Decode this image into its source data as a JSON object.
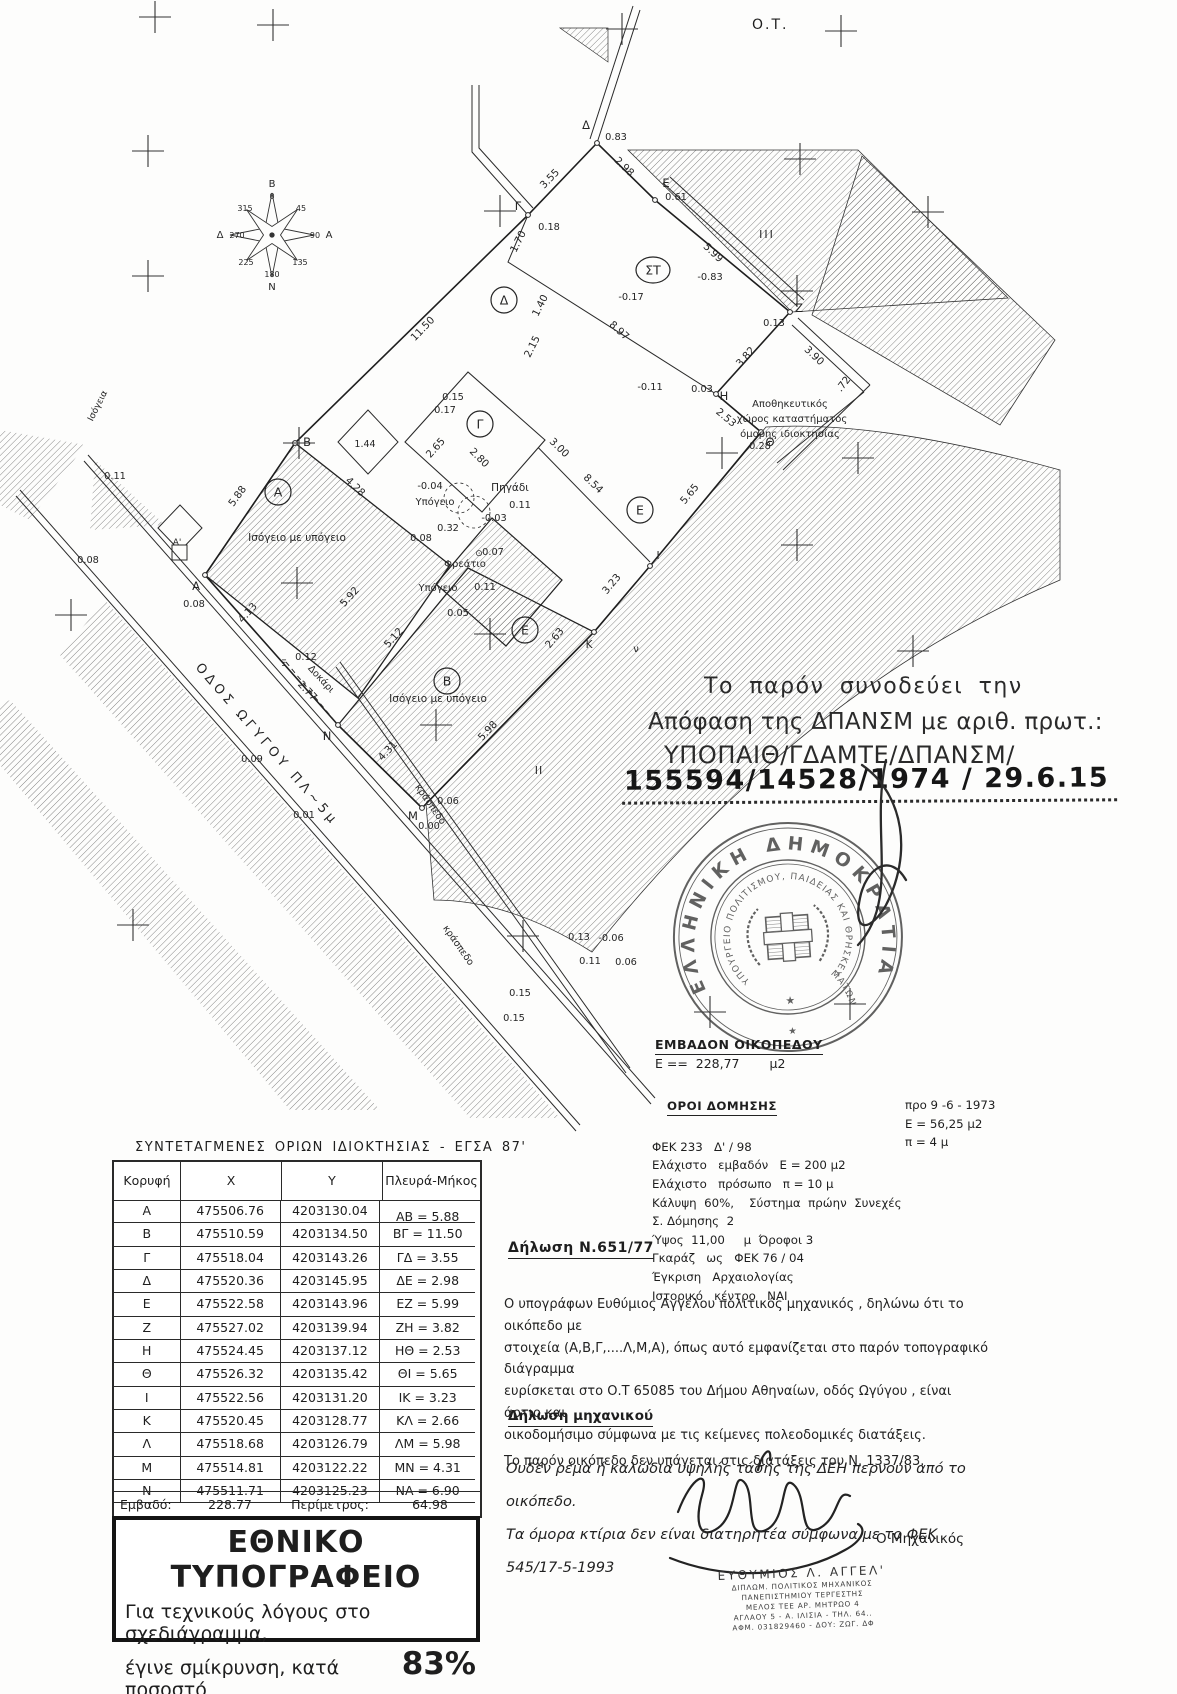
{
  "page": {
    "ot_label": "Ο.Τ."
  },
  "approval": {
    "line1": "Το παρόν συνοδεύει την",
    "line2": "Απόφαση της ΔΠΑΝΣΜ με αριθ. πρωτ.:",
    "line3": "ΥΠΟΠΑΙΘ/ΓΔΑΜΤΕ/ΔΠΑΝΣΜ/",
    "line4": "155594/14528/1974 / 29.6.15"
  },
  "stamp": {
    "outer_text": "ΕΛΛΗΝΙΚΗ ΔΗΜΟΚΡΑΤΙΑ",
    "inner_text": "ΥΠΟΥΡΓΕΙΟ ΠΟΛΙΤΙΣΜΟΥ, ΠΑΙΔΕΙΑΣ ΚΑΙ ΘΡΗΣΚΕΥΜΑΤΩΝ",
    "star1": "★",
    "star2": "★"
  },
  "area_block": {
    "title": "ΕΜΒΑΔΟΝ ΟΙΚΟΠΕΔΟΥ",
    "value": "Ε ==  228,77",
    "unit": "μ2"
  },
  "building_terms": {
    "title": "ΟΡΟΙ ΔΟΜΗΣΗΣ",
    "left_rows": [
      "ΦΕΚ 233   Δ' / 98",
      "Ελάχιστο   εμβαδόν   Ε = 200 μ2",
      "Ελάχιστο   πρόσωπο   π = 10 μ",
      "Κάλυψη  60%,    Σύστημα  πρώην  Συνεχές",
      "Σ. Δόμησης  2",
      "Ύψος  11,00     μ  Όροφοι 3",
      "Γκαράζ   ως   ΦΕΚ 76 / 04",
      "Έγκριση   Αρχαιολογίας",
      "Ιστορικό   κέντρο   ΝΑΙ"
    ],
    "right_rows": [
      "προ 9 -6 - 1973",
      "Ε = 56,25 μ2",
      "π = 4 μ"
    ]
  },
  "coords_table": {
    "title": "ΣΥΝΤΕΤΑΓΜΕΝΕΣ ΟΡΙΩΝ ΙΔΙΟΚΤΗΣΙΑΣ - ΕΓΣΑ 87'",
    "headers": [
      "Κορυφή",
      "X",
      "Y",
      "Πλευρά-Μήκος"
    ],
    "rows": [
      [
        "Α",
        "475506.76",
        "4203130.04"
      ],
      [
        "Β",
        "475510.59",
        "4203134.50"
      ],
      [
        "Γ",
        "475518.04",
        "4203143.26"
      ],
      [
        "Δ",
        "475520.36",
        "4203145.95"
      ],
      [
        "Ε",
        "475522.58",
        "4203143.96"
      ],
      [
        "Ζ",
        "475527.02",
        "4203139.94"
      ],
      [
        "Η",
        "475524.45",
        "4203137.12"
      ],
      [
        "Θ",
        "475526.32",
        "4203135.42"
      ],
      [
        "Ι",
        "475522.56",
        "4203131.20"
      ],
      [
        "Κ",
        "475520.45",
        "4203128.77"
      ],
      [
        "Λ",
        "475518.68",
        "4203126.79"
      ],
      [
        "Μ",
        "475514.81",
        "4203122.22"
      ],
      [
        "Ν",
        "475511.71",
        "4203125.23"
      ]
    ],
    "sides": [
      "ΑΒ = 5.88",
      "ΒΓ = 11.50",
      "ΓΔ = 3.55",
      "ΔΕ = 2.98",
      "ΕΖ = 5.99",
      "ΖΗ = 3.82",
      "ΗΘ = 2.53",
      "ΘΙ = 5.65",
      "ΙΚ = 3.23",
      "ΚΛ = 2.66",
      "ΛΜ = 5.98",
      "ΜΝ = 4.31",
      "ΝΑ = 6.90"
    ],
    "footer": {
      "area_label": "Εμβαδό:",
      "area": "228.77",
      "perimeter_label": "Περίμετρος:",
      "perimeter": "64.98"
    }
  },
  "print_box": {
    "title": "ΕΘΝΙΚΟ ΤΥΠΟΓΡΑΦΕΙΟ",
    "line1": "Για τεχνικούς λόγους στο σχεδιάγραμμα,",
    "line2_prefix": "έγινε σμίκρυνση, κατά ποσοστό",
    "percent": "83%"
  },
  "declaration_651": {
    "title": "Δήλωση  Ν.651/77",
    "lines": [
      "Ο υπογράφων Ευθύμιος Αγγέλου πολιτικός μηχανικός , δηλώνω ότι  το οικόπεδο με",
      "στοιχεία (Α,Β,Γ,....Λ,Μ,Α), όπως αυτό εμφανίζεται στο παρόν τοπογραφικό διάγραμμα",
      "ευρίσκεται στο Ο.Τ 65085 του Δήμου Αθηναίων, οδός Ωγύγου , είναι άρτιο και",
      "οικοδομήσιμο σύμφωνα με τις κείμενες  πολεοδομικές διατάξεις.",
      "Το παρόν οικόπεδο δεν υπάγεται στις διατάξεις του Ν. 1337/83."
    ]
  },
  "declaration_engineer": {
    "title": "Δήλωση μηχανικού",
    "lines": [
      "Ουδέν ρέμα ή καλώδια υψηλής τάσης της ΔΕΗ περνούν από το οικόπεδο.",
      "Τα όμορα κτίρια δεν είναι διατηρητέα  σύμφωνα με το ΦΕΚ 545/17-5-1993"
    ]
  },
  "signature": {
    "role": "Ο Μηχανικός",
    "stamp_lines": [
      "ΕΥΘΥΜΙΟΣ Λ. ΑΓΓΕΛ'",
      "ΔΙΠΛΩΜ. ΠΟΛΙΤΙΚΟΣ ΜΗΧΑΝΙΚΟΣ",
      "ΠΑΝΕΠΙΣΤΗΜΙΟΥ ΤΕΡΓΕΣΤΗΣ",
      "ΜΕΛΟΣ ΤΕΕ    ΑΡ. ΜΗΤΡΩΟ 4",
      "ΑΓΛΑΟΥ 5 - Α. ΙΛΙΣΙΑ  -  ΤΗΛ. 64..",
      "ΑΦΜ. 031829460  -  ΔΟΥ: ΖΩΓ. ΔΦ"
    ]
  },
  "map": {
    "street_name": "ΟΔΟΣ  ΩΓΥΓΟΥ  ΠΛ~5μ",
    "texts": [
      {
        "t": "Β",
        "x": 272,
        "y": 187,
        "s": 10
      },
      {
        "t": "0",
        "x": 272,
        "y": 199,
        "s": 8
      },
      {
        "t": "45",
        "x": 301,
        "y": 211,
        "s": 8
      },
      {
        "t": "90",
        "x": 315,
        "y": 238,
        "s": 8
      },
      {
        "t": "Α",
        "x": 329,
        "y": 238,
        "s": 10
      },
      {
        "t": "135",
        "x": 300,
        "y": 265,
        "s": 8
      },
      {
        "t": "180",
        "x": 272,
        "y": 277,
        "s": 8
      },
      {
        "t": "Ν",
        "x": 272,
        "y": 290,
        "s": 10
      },
      {
        "t": "225",
        "x": 246,
        "y": 265,
        "s": 8
      },
      {
        "t": "270",
        "x": 237,
        "y": 238,
        "s": 8
      },
      {
        "t": "Δ",
        "x": 220,
        "y": 238,
        "s": 10
      },
      {
        "t": "315",
        "x": 245,
        "y": 211,
        "s": 8
      },
      {
        "t": "Α",
        "x": 196,
        "y": 590,
        "s": 11.5
      },
      {
        "t": "Β",
        "x": 307,
        "y": 446,
        "s": 11.5
      },
      {
        "t": "Γ",
        "x": 518,
        "y": 210,
        "s": 11.5
      },
      {
        "t": "Δ",
        "x": 586,
        "y": 129,
        "s": 11.5
      },
      {
        "t": "Ε",
        "x": 666,
        "y": 187,
        "s": 11.5
      },
      {
        "t": "Ζ",
        "x": 799,
        "y": 312,
        "s": 11.5
      },
      {
        "t": "Η",
        "x": 724,
        "y": 400,
        "s": 11.5
      },
      {
        "t": "Θ",
        "x": 770,
        "y": 446,
        "s": 11.5
      },
      {
        "t": "Ι",
        "x": 658,
        "y": 559,
        "s": 10.5
      },
      {
        "t": "Κ",
        "x": 589,
        "y": 648,
        "s": 10.5
      },
      {
        "t": "Μ",
        "x": 413,
        "y": 820,
        "s": 11.5
      },
      {
        "t": "Ν",
        "x": 327,
        "y": 740,
        "s": 11.5
      },
      {
        "t": "Ξ",
        "x": 284,
        "y": 666,
        "s": 9
      },
      {
        "t": "ν",
        "x": 636,
        "y": 652,
        "s": 10
      },
      {
        "t": "Α'",
        "x": 177,
        "y": 545,
        "s": 9
      },
      {
        "t": "5.88",
        "x": 240,
        "y": 498,
        "r": -54
      },
      {
        "t": "4.28",
        "x": 353,
        "y": 489,
        "r": 44
      },
      {
        "t": "11.50",
        "x": 425,
        "y": 331,
        "r": -46
      },
      {
        "t": "3.55",
        "x": 552,
        "y": 181,
        "r": -46
      },
      {
        "t": "2.98",
        "x": 622,
        "y": 169,
        "r": 44
      },
      {
        "t": "5.99",
        "x": 711,
        "y": 255,
        "r": 43
      },
      {
        "t": "3.82",
        "x": 748,
        "y": 359,
        "r": -48
      },
      {
        "t": "2.53",
        "x": 724,
        "y": 420,
        "r": 40
      },
      {
        "t": "5.65",
        "x": 692,
        "y": 496,
        "r": -50
      },
      {
        "t": "3.23",
        "x": 614,
        "y": 586,
        "r": -50
      },
      {
        "t": "2.63",
        "x": 557,
        "y": 640,
        "r": -50
      },
      {
        "t": "5.98",
        "x": 490,
        "y": 733,
        "r": -47
      },
      {
        "t": "4.31",
        "x": 390,
        "y": 753,
        "r": -47
      },
      {
        "t": "5.12",
        "x": 396,
        "y": 640,
        "r": -48
      },
      {
        "t": "4.13",
        "x": 250,
        "y": 615,
        "r": -48
      },
      {
        "t": "5.92",
        "x": 352,
        "y": 599,
        "r": -48
      },
      {
        "t": "8.97",
        "x": 617,
        "y": 333,
        "r": 42
      },
      {
        "t": "8.54",
        "x": 591,
        "y": 486,
        "r": 44
      },
      {
        "t": "3.00",
        "x": 557,
        "y": 450,
        "r": 44
      },
      {
        "t": "2.80",
        "x": 477,
        "y": 460,
        "r": 45
      },
      {
        "t": "2.65",
        "x": 438,
        "y": 450,
        "r": -48
      },
      {
        "t": "1.70",
        "x": 521,
        "y": 243,
        "r": -63
      },
      {
        "t": "1.40",
        "x": 543,
        "y": 307,
        "r": -63
      },
      {
        "t": "2.15",
        "x": 535,
        "y": 348,
        "r": -63
      },
      {
        "t": "3.90",
        "x": 812,
        "y": 358,
        "r": 43
      },
      {
        "t": ".72",
        "x": 846,
        "y": 386,
        "r": -52
      },
      {
        "t": "2.77",
        "x": 305,
        "y": 693,
        "r": 47
      },
      {
        "t": "1.44",
        "x": 365,
        "y": 447,
        "s": 9.5
      },
      {
        "t": "Δοκάρι",
        "x": 319,
        "y": 681,
        "r": 47,
        "s": 9.5
      },
      {
        "t": "0.83",
        "x": 616,
        "y": 140,
        "s": 9.8
      },
      {
        "t": "0.61",
        "x": 676,
        "y": 200,
        "s": 9.8
      },
      {
        "t": "0.13",
        "x": 774,
        "y": 326,
        "s": 9.8
      },
      {
        "t": "-0.83",
        "x": 710,
        "y": 280,
        "s": 9.8
      },
      {
        "t": "-0.17",
        "x": 631,
        "y": 300,
        "s": 9.8
      },
      {
        "t": "-0.11",
        "x": 650,
        "y": 390,
        "s": 9.8
      },
      {
        "t": "0.03",
        "x": 702,
        "y": 392,
        "s": 9.8
      },
      {
        "t": "0.28",
        "x": 760,
        "y": 449,
        "s": 9.8
      },
      {
        "t": "0.18",
        "x": 549,
        "y": 230,
        "s": 9.8
      },
      {
        "t": "0.15",
        "x": 453,
        "y": 400,
        "s": 9.8
      },
      {
        "t": "0.17",
        "x": 445,
        "y": 413,
        "s": 9.8
      },
      {
        "t": "-0.04",
        "x": 430,
        "y": 489,
        "s": 9.8
      },
      {
        "t": "0.32",
        "x": 448,
        "y": 531,
        "s": 9.8
      },
      {
        "t": "0.08",
        "x": 421,
        "y": 541,
        "s": 9.8
      },
      {
        "t": "0.11",
        "x": 520,
        "y": 508,
        "s": 9.8
      },
      {
        "t": "-0.03",
        "x": 494,
        "y": 521,
        "s": 9.8
      },
      {
        "t": "0.07",
        "x": 493,
        "y": 555,
        "s": 9.8
      },
      {
        "t": "⊙",
        "x": 479,
        "y": 556,
        "s": 9
      },
      {
        "t": "0.11",
        "x": 485,
        "y": 590,
        "s": 9.8
      },
      {
        "t": "0.05",
        "x": 458,
        "y": 616,
        "s": 9.8
      },
      {
        "t": "0.12",
        "x": 306,
        "y": 660,
        "s": 9.8
      },
      {
        "t": "0.08",
        "x": 194,
        "y": 607,
        "s": 9.8
      },
      {
        "t": "0.09",
        "x": 252,
        "y": 762,
        "s": 9.8
      },
      {
        "t": "0.01",
        "x": 304,
        "y": 818,
        "s": 9.8
      },
      {
        "t": "0.00",
        "x": 429,
        "y": 829,
        "s": 9.8
      },
      {
        "t": "0.06",
        "x": 448,
        "y": 804,
        "s": 9.8
      },
      {
        "t": "0.11",
        "x": 115,
        "y": 479,
        "s": 9.8
      },
      {
        "t": "0.08",
        "x": 88,
        "y": 563,
        "s": 9.8
      },
      {
        "t": "0.13",
        "x": 579,
        "y": 940,
        "s": 9.8
      },
      {
        "t": "-0.06",
        "x": 611,
        "y": 941,
        "s": 9.8
      },
      {
        "t": "0.11",
        "x": 590,
        "y": 964,
        "s": 9.8
      },
      {
        "t": "0.06",
        "x": 626,
        "y": 965,
        "s": 9.8
      },
      {
        "t": "0.15",
        "x": 520,
        "y": 996,
        "s": 9.8
      },
      {
        "t": "0.15",
        "x": 514,
        "y": 1021,
        "s": 9.8
      },
      {
        "t": "Πηγάδι",
        "x": 510,
        "y": 491,
        "s": 10.5
      },
      {
        "t": "Υπόγειο",
        "x": 435,
        "y": 505,
        "s": 10
      },
      {
        "t": "Υπόγειο",
        "x": 438,
        "y": 591,
        "s": 10
      },
      {
        "t": "Φρεάτιο",
        "x": 465,
        "y": 567,
        "s": 10
      },
      {
        "t": "Ισόγειο με υπόγειο",
        "x": 297,
        "y": 541,
        "s": 10.5
      },
      {
        "t": "Ισόγειο με υπόγειο",
        "x": 438,
        "y": 702,
        "s": 10.5
      },
      {
        "t": "Αποθηκευτικός",
        "x": 790,
        "y": 407,
        "s": 10
      },
      {
        "t": "χώρος καταστήματος",
        "x": 792,
        "y": 422,
        "s": 10
      },
      {
        "t": "όμορης ιδιοκτησίας",
        "x": 790,
        "y": 437,
        "s": 10
      },
      {
        "t": "κράσπεδο",
        "x": 428,
        "y": 806,
        "r": 55,
        "s": 9.5
      },
      {
        "t": "κράσπεδο",
        "x": 456,
        "y": 947,
        "r": 55,
        "s": 9.5
      },
      {
        "t": "ΟΔΟΣ  ΩΓΥΓΟΥ  ΠΛ~5μ",
        "x": 264,
        "y": 747,
        "r": 49,
        "s": 13,
        "sp": 4
      },
      {
        "t": "Ισόγεια",
        "x": 100,
        "y": 407,
        "r": -63,
        "s": 9
      },
      {
        "t": "ΙΙΙ",
        "x": 767,
        "y": 238,
        "s": 11,
        "sp": 2
      },
      {
        "t": "ΙΙ",
        "x": 539,
        "y": 774,
        "s": 11,
        "sp": 1
      }
    ],
    "circled": [
      {
        "t": "Α",
        "x": 278,
        "y": 492
      },
      {
        "t": "Β",
        "x": 447,
        "y": 681
      },
      {
        "t": "Γ",
        "x": 480,
        "y": 424
      },
      {
        "t": "Δ",
        "x": 504,
        "y": 300
      },
      {
        "t": "Ε",
        "x": 640,
        "y": 510
      },
      {
        "t": "Ε",
        "x": 525,
        "y": 630
      },
      {
        "t": "ΣΤ",
        "x": 653,
        "y": 270,
        "w": 17
      }
    ],
    "crosses": [
      [
        155,
        17
      ],
      [
        273,
        25
      ],
      [
        622,
        29
      ],
      [
        841,
        31
      ],
      [
        148,
        151
      ],
      [
        800,
        159
      ],
      [
        500,
        211
      ],
      [
        928,
        212
      ],
      [
        148,
        276
      ],
      [
        797,
        291
      ],
      [
        299,
        443
      ],
      [
        722,
        453
      ],
      [
        858,
        458
      ],
      [
        797,
        545
      ],
      [
        297,
        583
      ],
      [
        71,
        615
      ],
      [
        490,
        634
      ],
      [
        913,
        651
      ],
      [
        436,
        725
      ],
      [
        133,
        925
      ],
      [
        523,
        936
      ],
      [
        850,
        1004
      ],
      [
        710,
        1012
      ]
    ]
  }
}
